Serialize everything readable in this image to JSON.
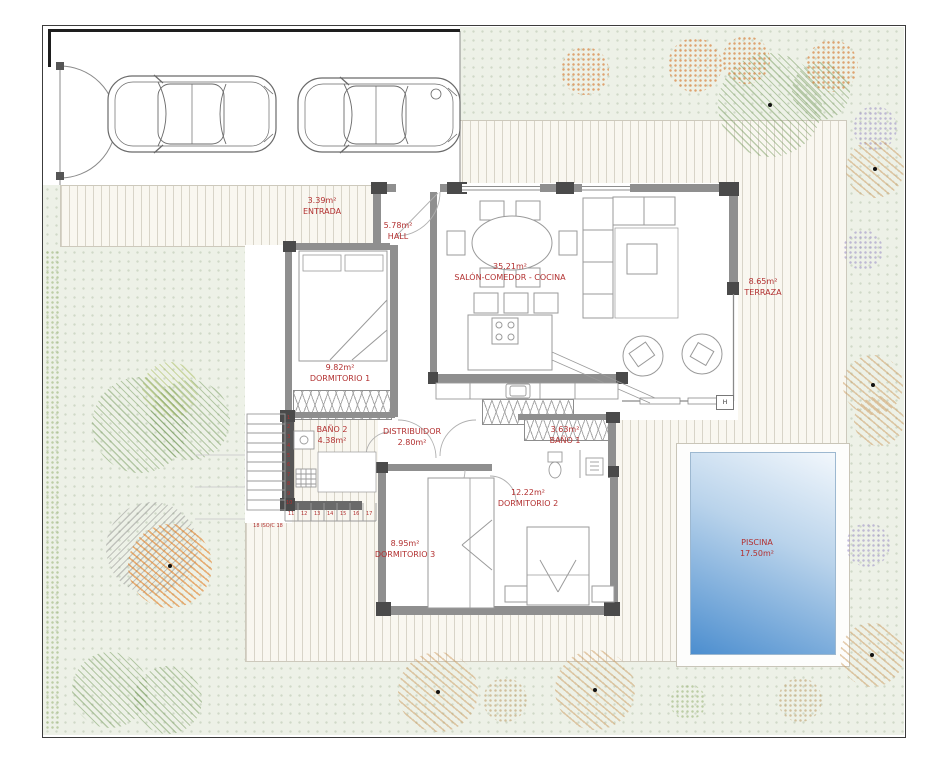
{
  "plan_title": "villa-floor-plan",
  "colors": {
    "label_red": "#b23030",
    "wall_gray": "#8f8f8f",
    "wall_dark": "#4a4a4a",
    "deck_cream": "#f9f7f0",
    "garden_green": "#edf1e7",
    "pool_blue_dark": "#4c8ecf",
    "pool_blue_light": "#f2f7fc"
  },
  "rooms": {
    "entrada": {
      "area": "3.39m²",
      "name": "ENTRADA"
    },
    "hall": {
      "area": "5.78m²",
      "name": "HALL"
    },
    "salon": {
      "area": "35.21m²",
      "name": "SALÓN-COMEDOR - COCINA"
    },
    "terraza": {
      "area": "8.65m²",
      "name": "TERRAZA"
    },
    "dormitorio1": {
      "area": "9.82m²",
      "name": "DORMITORIO 1"
    },
    "bano2": {
      "name": "BAÑO 2",
      "area": "4.38m²"
    },
    "distribuidor": {
      "name": "DISTRIBUIDOR",
      "area": "2.80m²"
    },
    "bano1": {
      "area": "3.63m²",
      "name": "BAÑO 1"
    },
    "dormitorio2": {
      "area": "12.22m²",
      "name": "DORMITORIO 2"
    },
    "dormitorio3": {
      "area": "8.95m²",
      "name": "DORMITORIO 3"
    },
    "piscina": {
      "name": "PISCINA",
      "area": "17.50m²"
    }
  },
  "stairs": {
    "note": "18 ISO/C 18",
    "left_numbers": [
      "1",
      "2",
      "3",
      "4",
      "5",
      "6",
      "7",
      "8",
      "9",
      "10"
    ],
    "bottom_numbers": [
      "11",
      "12",
      "13",
      "14",
      "15",
      "16",
      "17"
    ]
  },
  "markers": {
    "column_h": "H"
  }
}
